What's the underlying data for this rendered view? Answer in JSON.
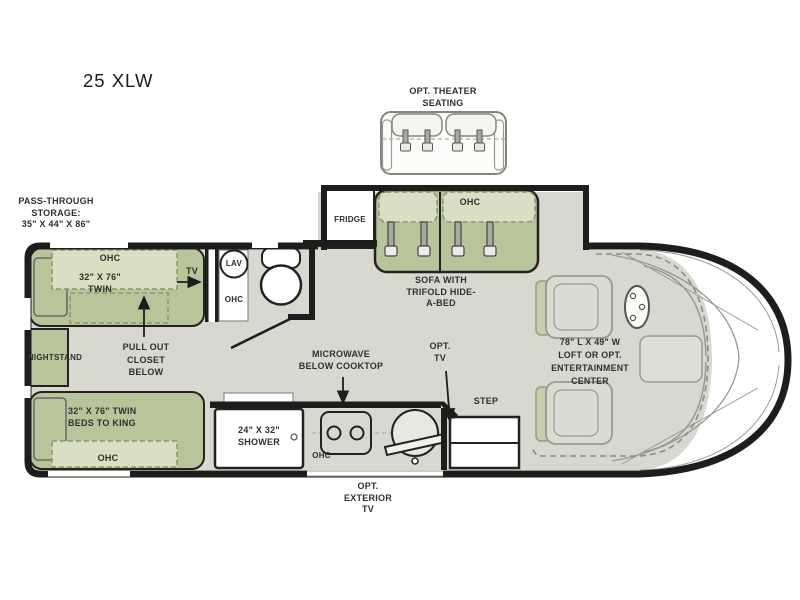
{
  "title": "25 XLW",
  "colors": {
    "furniture_green": "#b8c59a",
    "furniture_light_green": "#dadfc4",
    "floor_gray": "#d9d8d0",
    "wall_black": "#1d1d1b",
    "outline_gray": "#99998f"
  },
  "labels": {
    "theater": "OPT. THEATER\nSEATING",
    "pass_through": "PASS-THROUGH\nSTORAGE:\n35\" X 44\" X 86\"",
    "fridge": "FRIDGE",
    "sofa_ohc": "OHC",
    "sofa": "SOFA WITH\nTRIFOLD HIDE-\nA-BED",
    "bed1_ohc": "OHC",
    "bed1": "32\" X 76\"\nTWIN",
    "tv": "TV",
    "lav": "LAV",
    "bath_ohc": "OHC",
    "nightstand": "NIGHTSTAND",
    "closet": "PULL OUT\nCLOSET\nBELOW",
    "bed2": "32\" X 76\" TWIN\nBEDS TO KING",
    "bed2_ohc": "OHC",
    "shower": "24\" X 32\"\nSHOWER",
    "microwave": "MICROWAVE\nBELOW COOKTOP",
    "kitchen_ohc": "OHC",
    "opt_tv": "OPT.\nTV",
    "step": "STEP",
    "exterior_tv": "OPT.\nEXTERIOR\nTV",
    "loft": "78\" L X 49\" W\nLOFT OR OPT.\nENTERTAINMENT\nCENTER"
  }
}
